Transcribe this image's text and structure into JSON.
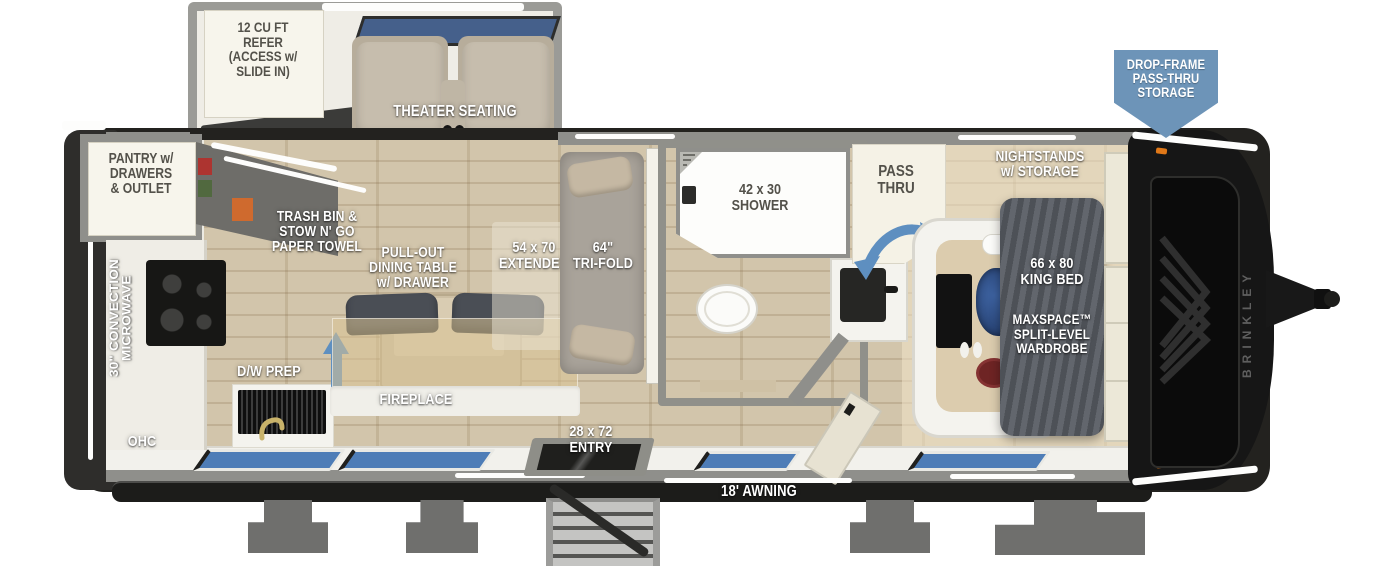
{
  "title": "Travel trailer floorplan diagram",
  "brand": "BRINKLEY",
  "badge": {
    "text": "DROP-FRAME\nPASS-THRU\nSTORAGE"
  },
  "labels": {
    "refer": "12 CU FT\nREFER\n(ACCESS w/\nSLIDE IN)",
    "theater": "THEATER SEATING",
    "pantry": "PANTRY w/\nDRAWERS\n& OUTLET",
    "microwave": "30\" CONVECTION\nMICROWAVE",
    "ohc": "OHC",
    "trash": "TRASH BIN &\nSTOW N' GO\nPAPER TOWEL",
    "dining": "PULL-OUT\nDINING TABLE\nw/ DRAWER",
    "dw_prep": "D/W PREP",
    "fireplace": "FIREPLACE",
    "extended": "54 x 70\nEXTENDED",
    "trifold": "64\"\nTRI-FOLD",
    "shower": "42 x 30\nSHOWER",
    "passthru": "PASS\nTHRU",
    "nightstands": "NIGHTSTANDS\nw/ STORAGE",
    "king_bed": "66 x 80\nKING BED",
    "wardrobe": "MAXSPACE™\nSPLIT-LEVEL\nWARDROBE",
    "entry": "28 x 72\nENTRY",
    "awning": "18' AWNING"
  },
  "colors": {
    "badge_blue": "#6d94b8",
    "arrow_blue": "#5e8fc0",
    "window_blue": "#4e7db7",
    "wood_floor": "#cfc1a5",
    "wall_gray": "#8f8f8b",
    "chassis_black": "#1c1c1a",
    "bed_gray": "#5a5e65",
    "sofa_tan": "#c6bdad",
    "label_cream": "#f7f5ec"
  }
}
